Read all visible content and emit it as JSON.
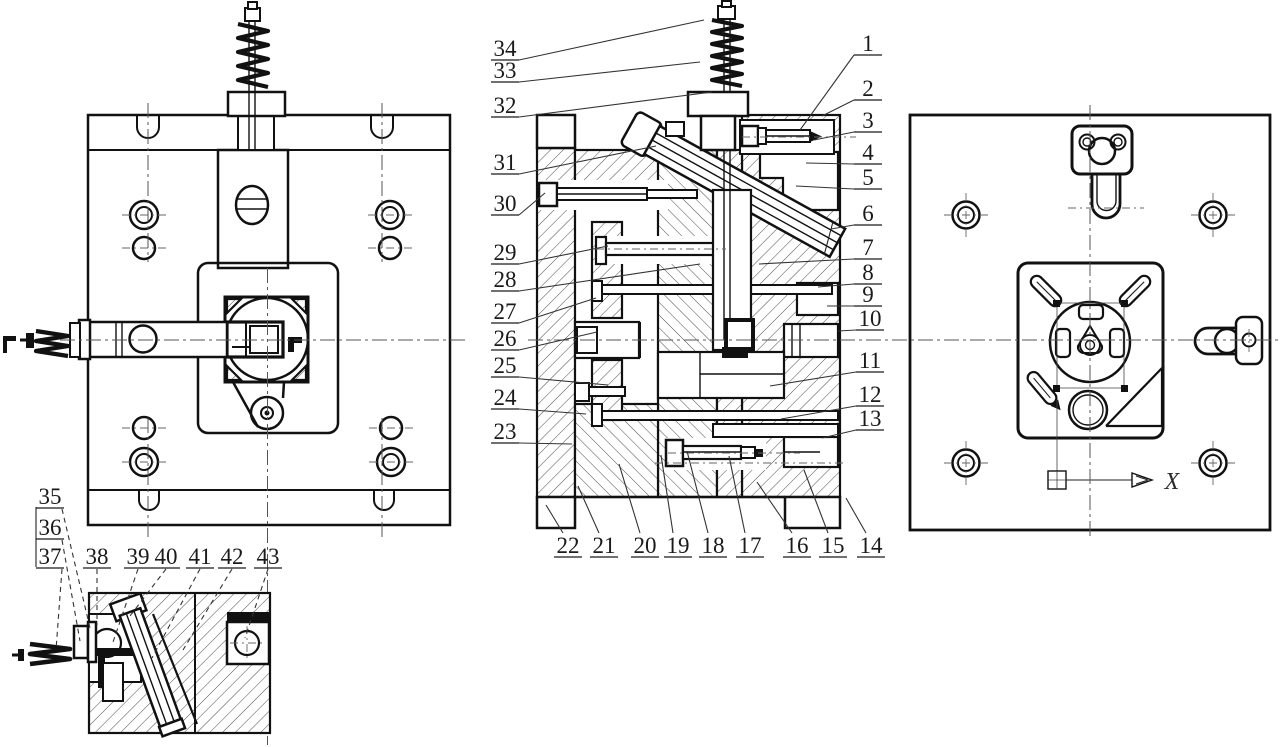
{
  "drawing": {
    "background": "#ffffff",
    "line_color": "#111111",
    "hatch_color": "#3a3a3a",
    "callout_color": "#1a1a1a"
  },
  "right_view": {
    "axis_label": "X"
  },
  "callouts": {
    "left_column": [
      {
        "n": "34",
        "x": 505,
        "y": 48,
        "tx": 704,
        "ty": 20
      },
      {
        "n": "33",
        "x": 505,
        "y": 70,
        "tx": 700,
        "ty": 62
      },
      {
        "n": "32",
        "x": 505,
        "y": 105,
        "tx": 712,
        "ty": 92
      },
      {
        "n": "31",
        "x": 505,
        "y": 162,
        "tx": 656,
        "ty": 146
      },
      {
        "n": "30",
        "x": 505,
        "y": 203,
        "tx": 545,
        "ty": 193
      },
      {
        "n": "29",
        "x": 505,
        "y": 252,
        "tx": 608,
        "ty": 246
      },
      {
        "n": "28",
        "x": 505,
        "y": 279,
        "tx": 700,
        "ty": 264
      },
      {
        "n": "27",
        "x": 505,
        "y": 311,
        "tx": 596,
        "ty": 298
      },
      {
        "n": "26",
        "x": 505,
        "y": 338,
        "tx": 597,
        "ty": 332
      },
      {
        "n": "25",
        "x": 505,
        "y": 365,
        "tx": 608,
        "ty": 385
      },
      {
        "n": "24",
        "x": 505,
        "y": 397,
        "tx": 586,
        "ty": 414
      },
      {
        "n": "23",
        "x": 505,
        "y": 431,
        "tx": 572,
        "ty": 444
      }
    ],
    "right_column": [
      {
        "n": "1",
        "x": 868,
        "y": 43,
        "tx": 800,
        "ty": 130
      },
      {
        "n": "2",
        "x": 868,
        "y": 88,
        "tx": 822,
        "ty": 116
      },
      {
        "n": "3",
        "x": 868,
        "y": 120,
        "tx": 814,
        "ty": 140
      },
      {
        "n": "4",
        "x": 868,
        "y": 152,
        "tx": 806,
        "ty": 163
      },
      {
        "n": "5",
        "x": 868,
        "y": 177,
        "tx": 796,
        "ty": 186
      },
      {
        "n": "6",
        "x": 868,
        "y": 213,
        "tx": 831,
        "ty": 229
      },
      {
        "n": "7",
        "x": 868,
        "y": 247,
        "tx": 759,
        "ty": 264
      },
      {
        "n": "8",
        "x": 868,
        "y": 272,
        "tx": 818,
        "ty": 287
      },
      {
        "n": "9",
        "x": 868,
        "y": 294,
        "tx": 827,
        "ty": 306
      },
      {
        "n": "10",
        "x": 870,
        "y": 318,
        "tx": 838,
        "ty": 331
      },
      {
        "n": "11",
        "x": 870,
        "y": 360,
        "tx": 770,
        "ty": 386
      },
      {
        "n": "12",
        "x": 870,
        "y": 394,
        "tx": 781,
        "ty": 419
      },
      {
        "n": "13",
        "x": 870,
        "y": 418,
        "tx": 822,
        "ty": 438
      }
    ],
    "bottom_row": [
      {
        "n": "22",
        "x": 568,
        "y": 545,
        "tx": 546,
        "ty": 505
      },
      {
        "n": "21",
        "x": 604,
        "y": 545,
        "tx": 578,
        "ty": 486
      },
      {
        "n": "20",
        "x": 645,
        "y": 545,
        "tx": 619,
        "ty": 464
      },
      {
        "n": "19",
        "x": 678,
        "y": 545,
        "tx": 661,
        "ty": 455
      },
      {
        "n": "18",
        "x": 713,
        "y": 545,
        "tx": 687,
        "ty": 451
      },
      {
        "n": "17",
        "x": 750,
        "y": 545,
        "tx": 729,
        "ty": 456
      },
      {
        "n": "16",
        "x": 797,
        "y": 545,
        "tx": 757,
        "ty": 482
      },
      {
        "n": "15",
        "x": 833,
        "y": 545,
        "tx": 804,
        "ty": 470
      },
      {
        "n": "14",
        "x": 871,
        "y": 545,
        "tx": 846,
        "ty": 498
      }
    ],
    "detail_stack": [
      {
        "n": "35",
        "x": 50,
        "y": 496,
        "tx": 90,
        "ty": 628
      },
      {
        "n": "36",
        "x": 50,
        "y": 527,
        "tx": 80,
        "ty": 641
      },
      {
        "n": "37",
        "x": 50,
        "y": 556,
        "tx": 56,
        "ty": 650
      }
    ],
    "detail_top": [
      {
        "n": "38",
        "x": 97,
        "y": 556,
        "tx": 97,
        "ty": 625
      },
      {
        "n": "39",
        "x": 138,
        "y": 556,
        "tx": 112,
        "ty": 645
      },
      {
        "n": "40",
        "x": 166,
        "y": 556,
        "tx": 130,
        "ty": 616
      },
      {
        "n": "41",
        "x": 200,
        "y": 556,
        "tx": 152,
        "ty": 658
      },
      {
        "n": "42",
        "x": 232,
        "y": 556,
        "tx": 183,
        "ty": 650
      },
      {
        "n": "43",
        "x": 268,
        "y": 556,
        "tx": 245,
        "ty": 638
      }
    ]
  }
}
